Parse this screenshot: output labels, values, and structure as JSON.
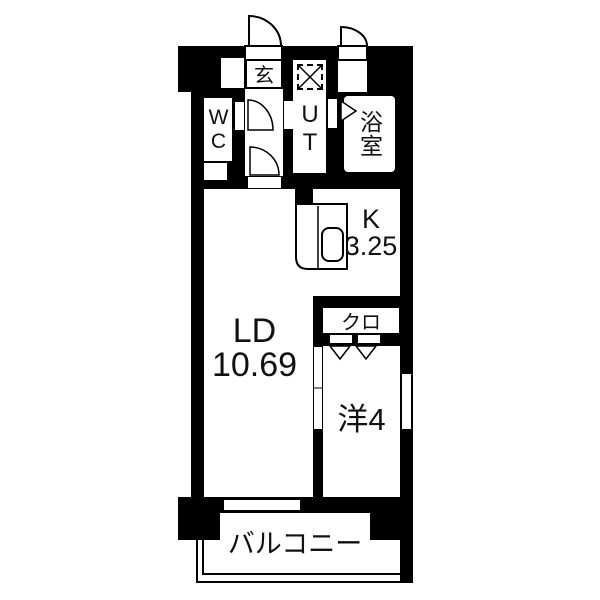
{
  "floorplan": {
    "type": "japanese-apartment-floor-plan",
    "colors": {
      "wall": "#000000",
      "floor": "#ffffff",
      "line": "#000000"
    },
    "rooms": {
      "genkan": {
        "label": "玄"
      },
      "wc": {
        "label": "WC"
      },
      "utility": {
        "label": "UT"
      },
      "bath": {
        "label": "浴室"
      },
      "kitchen": {
        "label": "K",
        "area": "3.25"
      },
      "living": {
        "label": "LD",
        "area": "10.69"
      },
      "closet": {
        "label": "クロ"
      },
      "western_room": {
        "label": "洋4"
      },
      "balcony": {
        "label": "バルコニー"
      }
    },
    "symbols": {
      "washing_machine": "dashed-box-with-x",
      "doors": [
        "entrance-swing-door",
        "storage-swing-door",
        "wc-swing-door",
        "hall-swing-door",
        "bath-folding-door",
        "closet-folding-door",
        "room-divider-sliding-door"
      ],
      "windows": [
        "balcony-sliding-window",
        "side-window"
      ],
      "fixtures": [
        "kitchen-counter",
        "kitchen-sink"
      ]
    }
  }
}
